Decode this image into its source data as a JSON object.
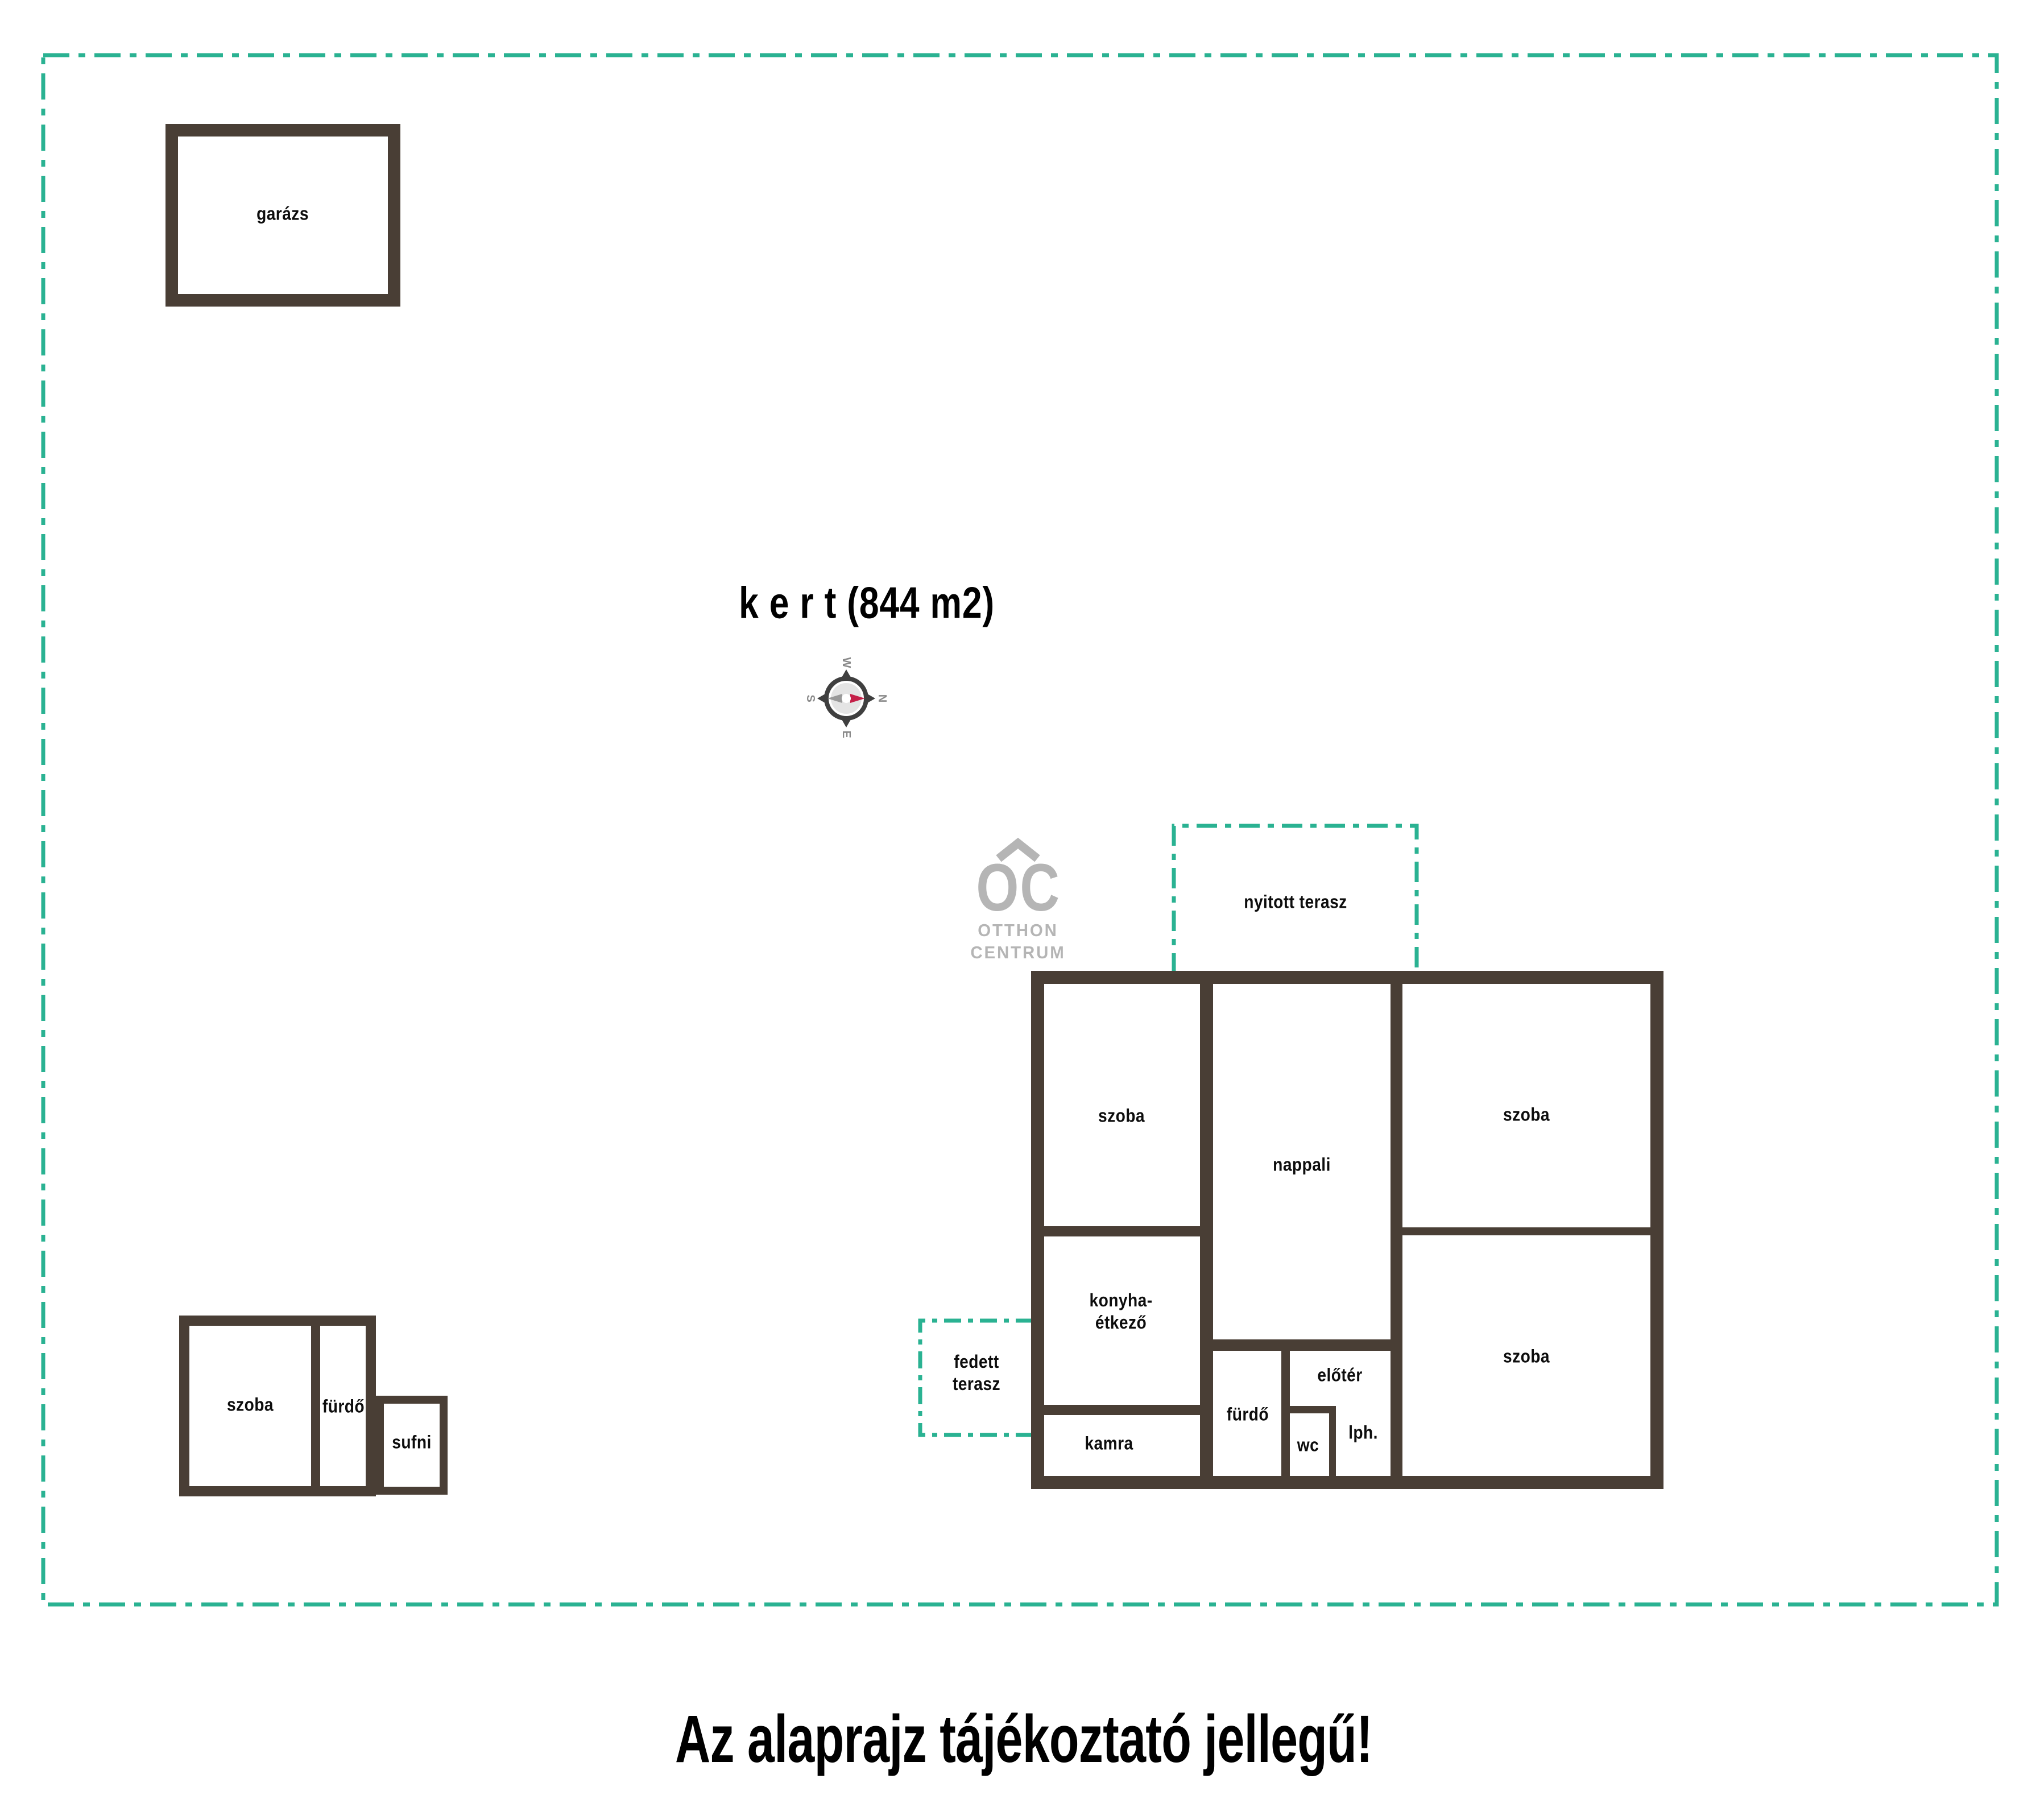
{
  "title": {
    "garden_label": "k e r t  (844 m2)",
    "disclaimer": "Az alaprajz tájékoztató jellegű!"
  },
  "colors": {
    "wall_brown": "#493e35",
    "boundary_teal": "#2ab292",
    "logo_gray": "#b5b5b5",
    "compass_ring": "#3f3f3f",
    "compass_red": "#c41f48",
    "compass_gray_needle": "#999999"
  },
  "outbuildings": {
    "garage_label": "garázs",
    "annex_room_label": "szoba",
    "annex_bath_label": "fürdő",
    "annex_shed_label": "sufni"
  },
  "terraces": {
    "open_label": "nyitott terasz",
    "covered_line1": "fedett",
    "covered_line2": "terasz"
  },
  "house_rooms": {
    "room_top_left": "szoba",
    "living_room": "nappali",
    "room_top_right": "szoba",
    "kitchen_line1": "konyha-",
    "kitchen_line2": "étkező",
    "pantry": "kamra",
    "bath": "fürdő",
    "hall": "előtér",
    "wc": "wc",
    "staircase": "lph.",
    "room_bottom_right": "szoba"
  },
  "compass": {
    "north": "N",
    "south": "S",
    "east": "E",
    "west": "W"
  },
  "logo": {
    "monogram": "OC",
    "word1": "OTTHON",
    "word2": "CENTRUM"
  }
}
